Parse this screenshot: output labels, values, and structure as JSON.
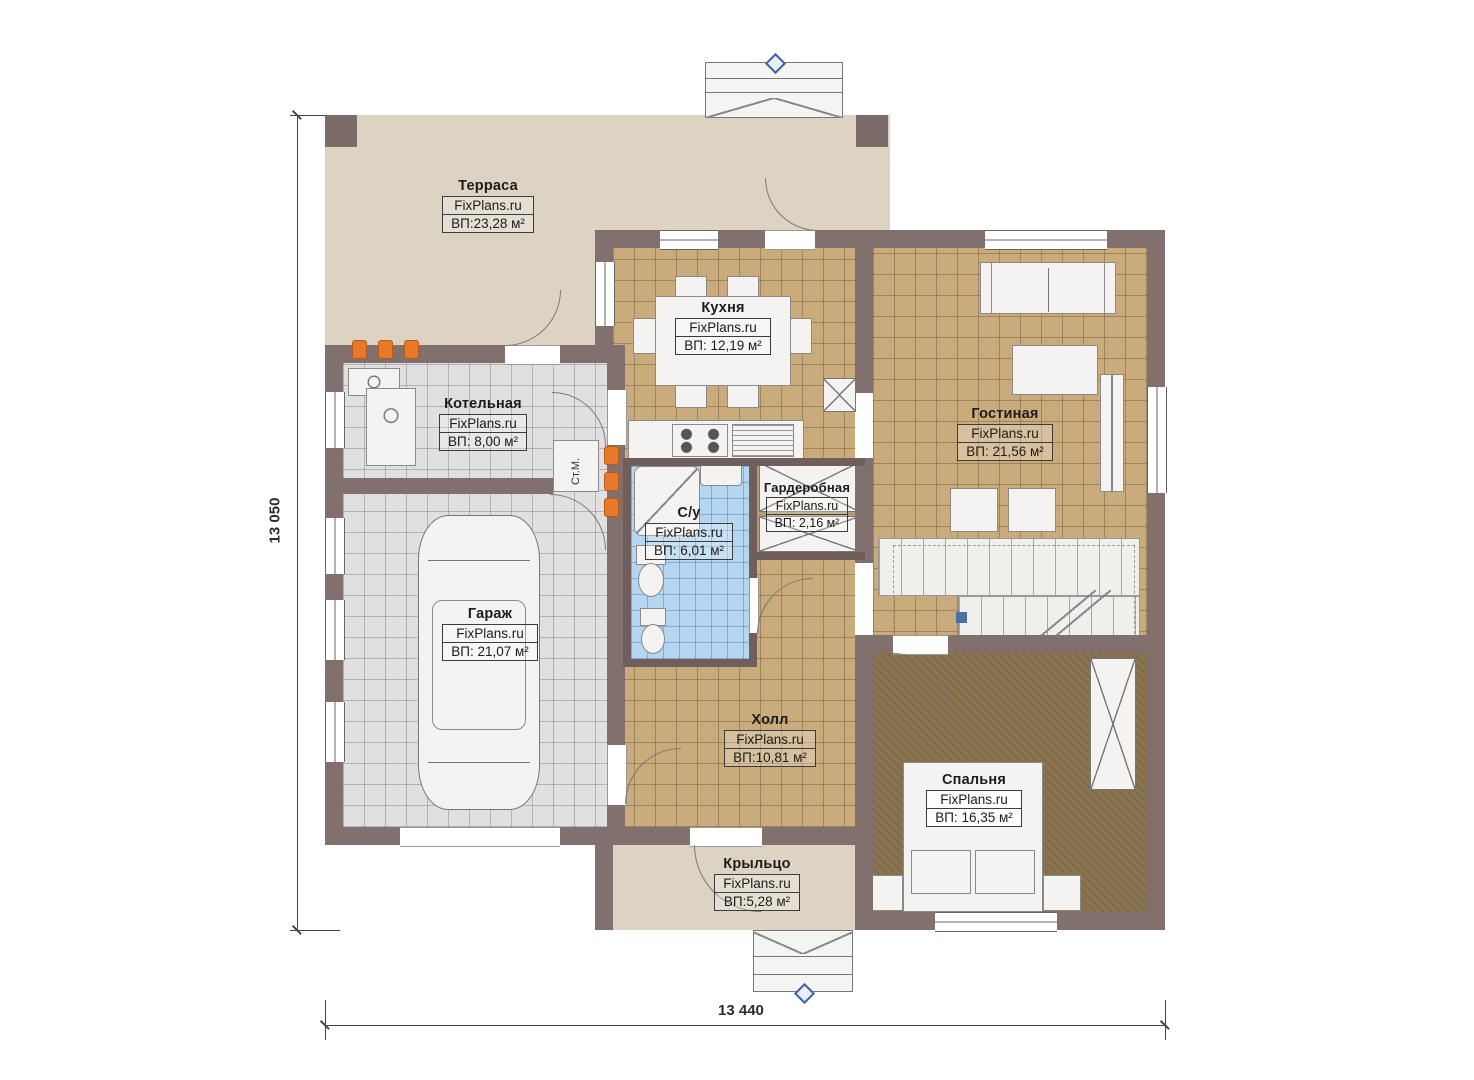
{
  "brand": "FixPlans.ru",
  "rooms": {
    "terrace": {
      "name": "Терраса",
      "area": "ВП:23,28 м²"
    },
    "kitchen": {
      "name": "Кухня",
      "area": "ВП: 12,19 м²"
    },
    "boiler": {
      "name": "Котельная",
      "area": "ВП: 8,00 м²"
    },
    "living": {
      "name": "Гостиная",
      "area": "ВП: 21,56 м²"
    },
    "wardrobe": {
      "name": "Гардеробная",
      "area": "ВП: 2,16 м²"
    },
    "bathroom": {
      "name": "С/у",
      "area": "ВП: 6,01 м²"
    },
    "garage": {
      "name": "Гараж",
      "area": "ВП: 21,07 м²"
    },
    "hall": {
      "name": "Холл",
      "area": "ВП:10,81 м²"
    },
    "bedroom": {
      "name": "Спальня",
      "area": "ВП: 16,35 м²"
    },
    "porch": {
      "name": "Крыльцо",
      "area": "ВП:5,28 м²"
    }
  },
  "annotations": {
    "washing_machine": "Ст.М."
  },
  "dimensions": {
    "left": "13 050",
    "bottom": "13 440"
  },
  "colors": {
    "wall": "#82706e",
    "floor_tan": "#c9ab7c",
    "floor_gray": "#e0e0e0",
    "floor_blue": "#b5d6f1",
    "floor_beige": "#ddd3c3",
    "floor_bedroom": "#8a734f",
    "radiator_orange": "#e8782a",
    "marker_blue": "#4a6fa5"
  }
}
